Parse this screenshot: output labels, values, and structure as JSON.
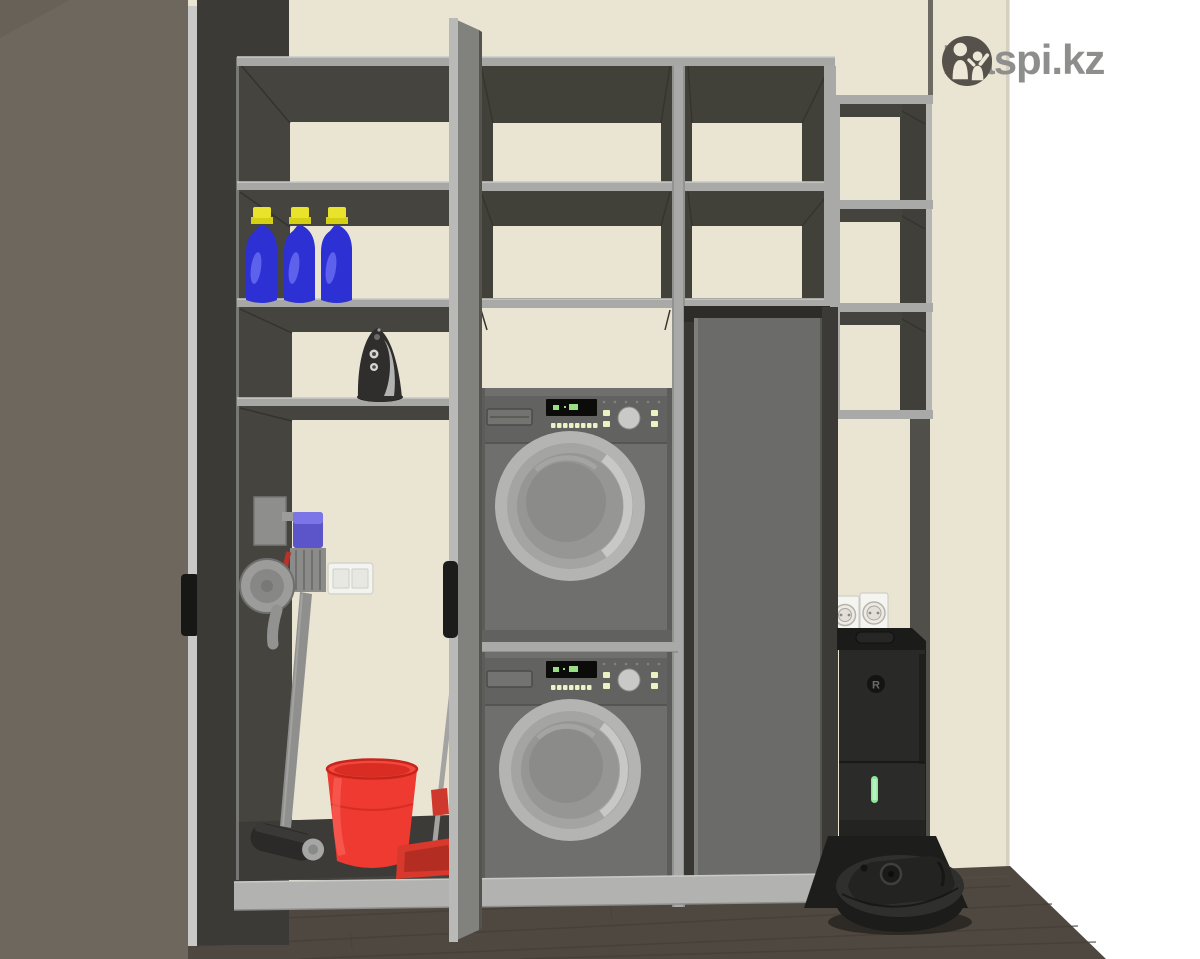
{
  "brand": {
    "logo_text": "Kaspi.kz",
    "circle_color": "#56524b",
    "text_color": "#8e8e8c"
  },
  "room": {
    "wall_color": "#eae5d3",
    "floor_color": "#4f4840",
    "background_color": "#ffffff"
  },
  "cabinet": {
    "frame_color": "#a9a9a7",
    "interior_color": "#45443f",
    "open_door_color": "#6e675e",
    "middle_door_color": "#81817d",
    "tall_door_color": "#6b6b69"
  },
  "appliances": {
    "washer": {
      "body_color": "#6f6f6d",
      "display_led_color": "#9ade84",
      "button_led_color": "#ecf2c2"
    },
    "dryer": {
      "body_color": "#6f6f6d",
      "display_led_color": "#9ade84",
      "button_led_color": "#ecf2c2"
    },
    "robot_dock": {
      "logo_letter": "R",
      "led_color": "#8ce69c"
    }
  },
  "items": {
    "detergent_bottles": {
      "count": 3,
      "body_color": "#2d31d4",
      "cap_color": "#e9e32b"
    },
    "bucket_color": "#ee3a31",
    "dustpan_color": "#d9382c",
    "stick_vacuum_accent": "#5b55c9"
  }
}
